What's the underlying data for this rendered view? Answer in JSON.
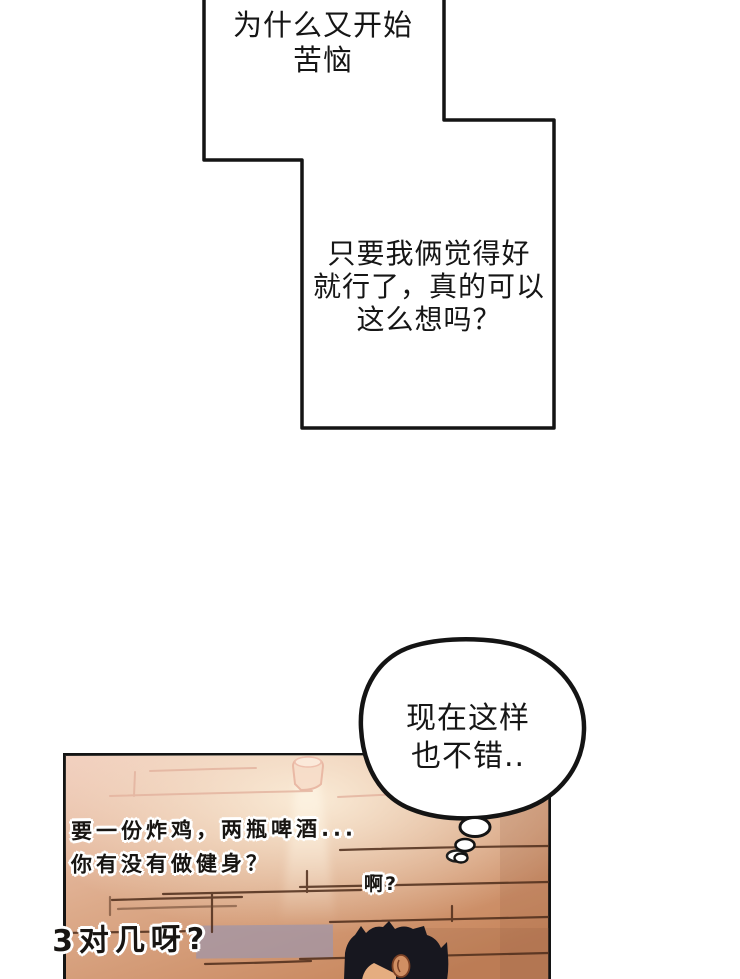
{
  "bubbles": {
    "top": {
      "line1": "为什么又开始",
      "line2": "苦恼"
    },
    "question": {
      "line1": "只要我俩觉得好",
      "line2": "就行了，真的可以",
      "line3": "这么想吗？"
    },
    "thought": {
      "line1": "现在这样",
      "line2": "也不错.."
    }
  },
  "panel": {
    "offscreen_line1": "要一份炸鸡，两瓶啤酒...",
    "offscreen_line2": "你有没有做健身？",
    "reply": "啊?",
    "shout": "3对几呀?"
  },
  "colors": {
    "outline": "#141414",
    "wall_top": "#f1cdbd",
    "wall_mid": "#ddab8b",
    "wall_bottom": "#c6845a",
    "light_beam": "#fdf3e2",
    "purple_plank": "#a095a8",
    "plank_line": "#4e2d1b",
    "hair": "#17171f",
    "skin": "#e5ad80"
  }
}
